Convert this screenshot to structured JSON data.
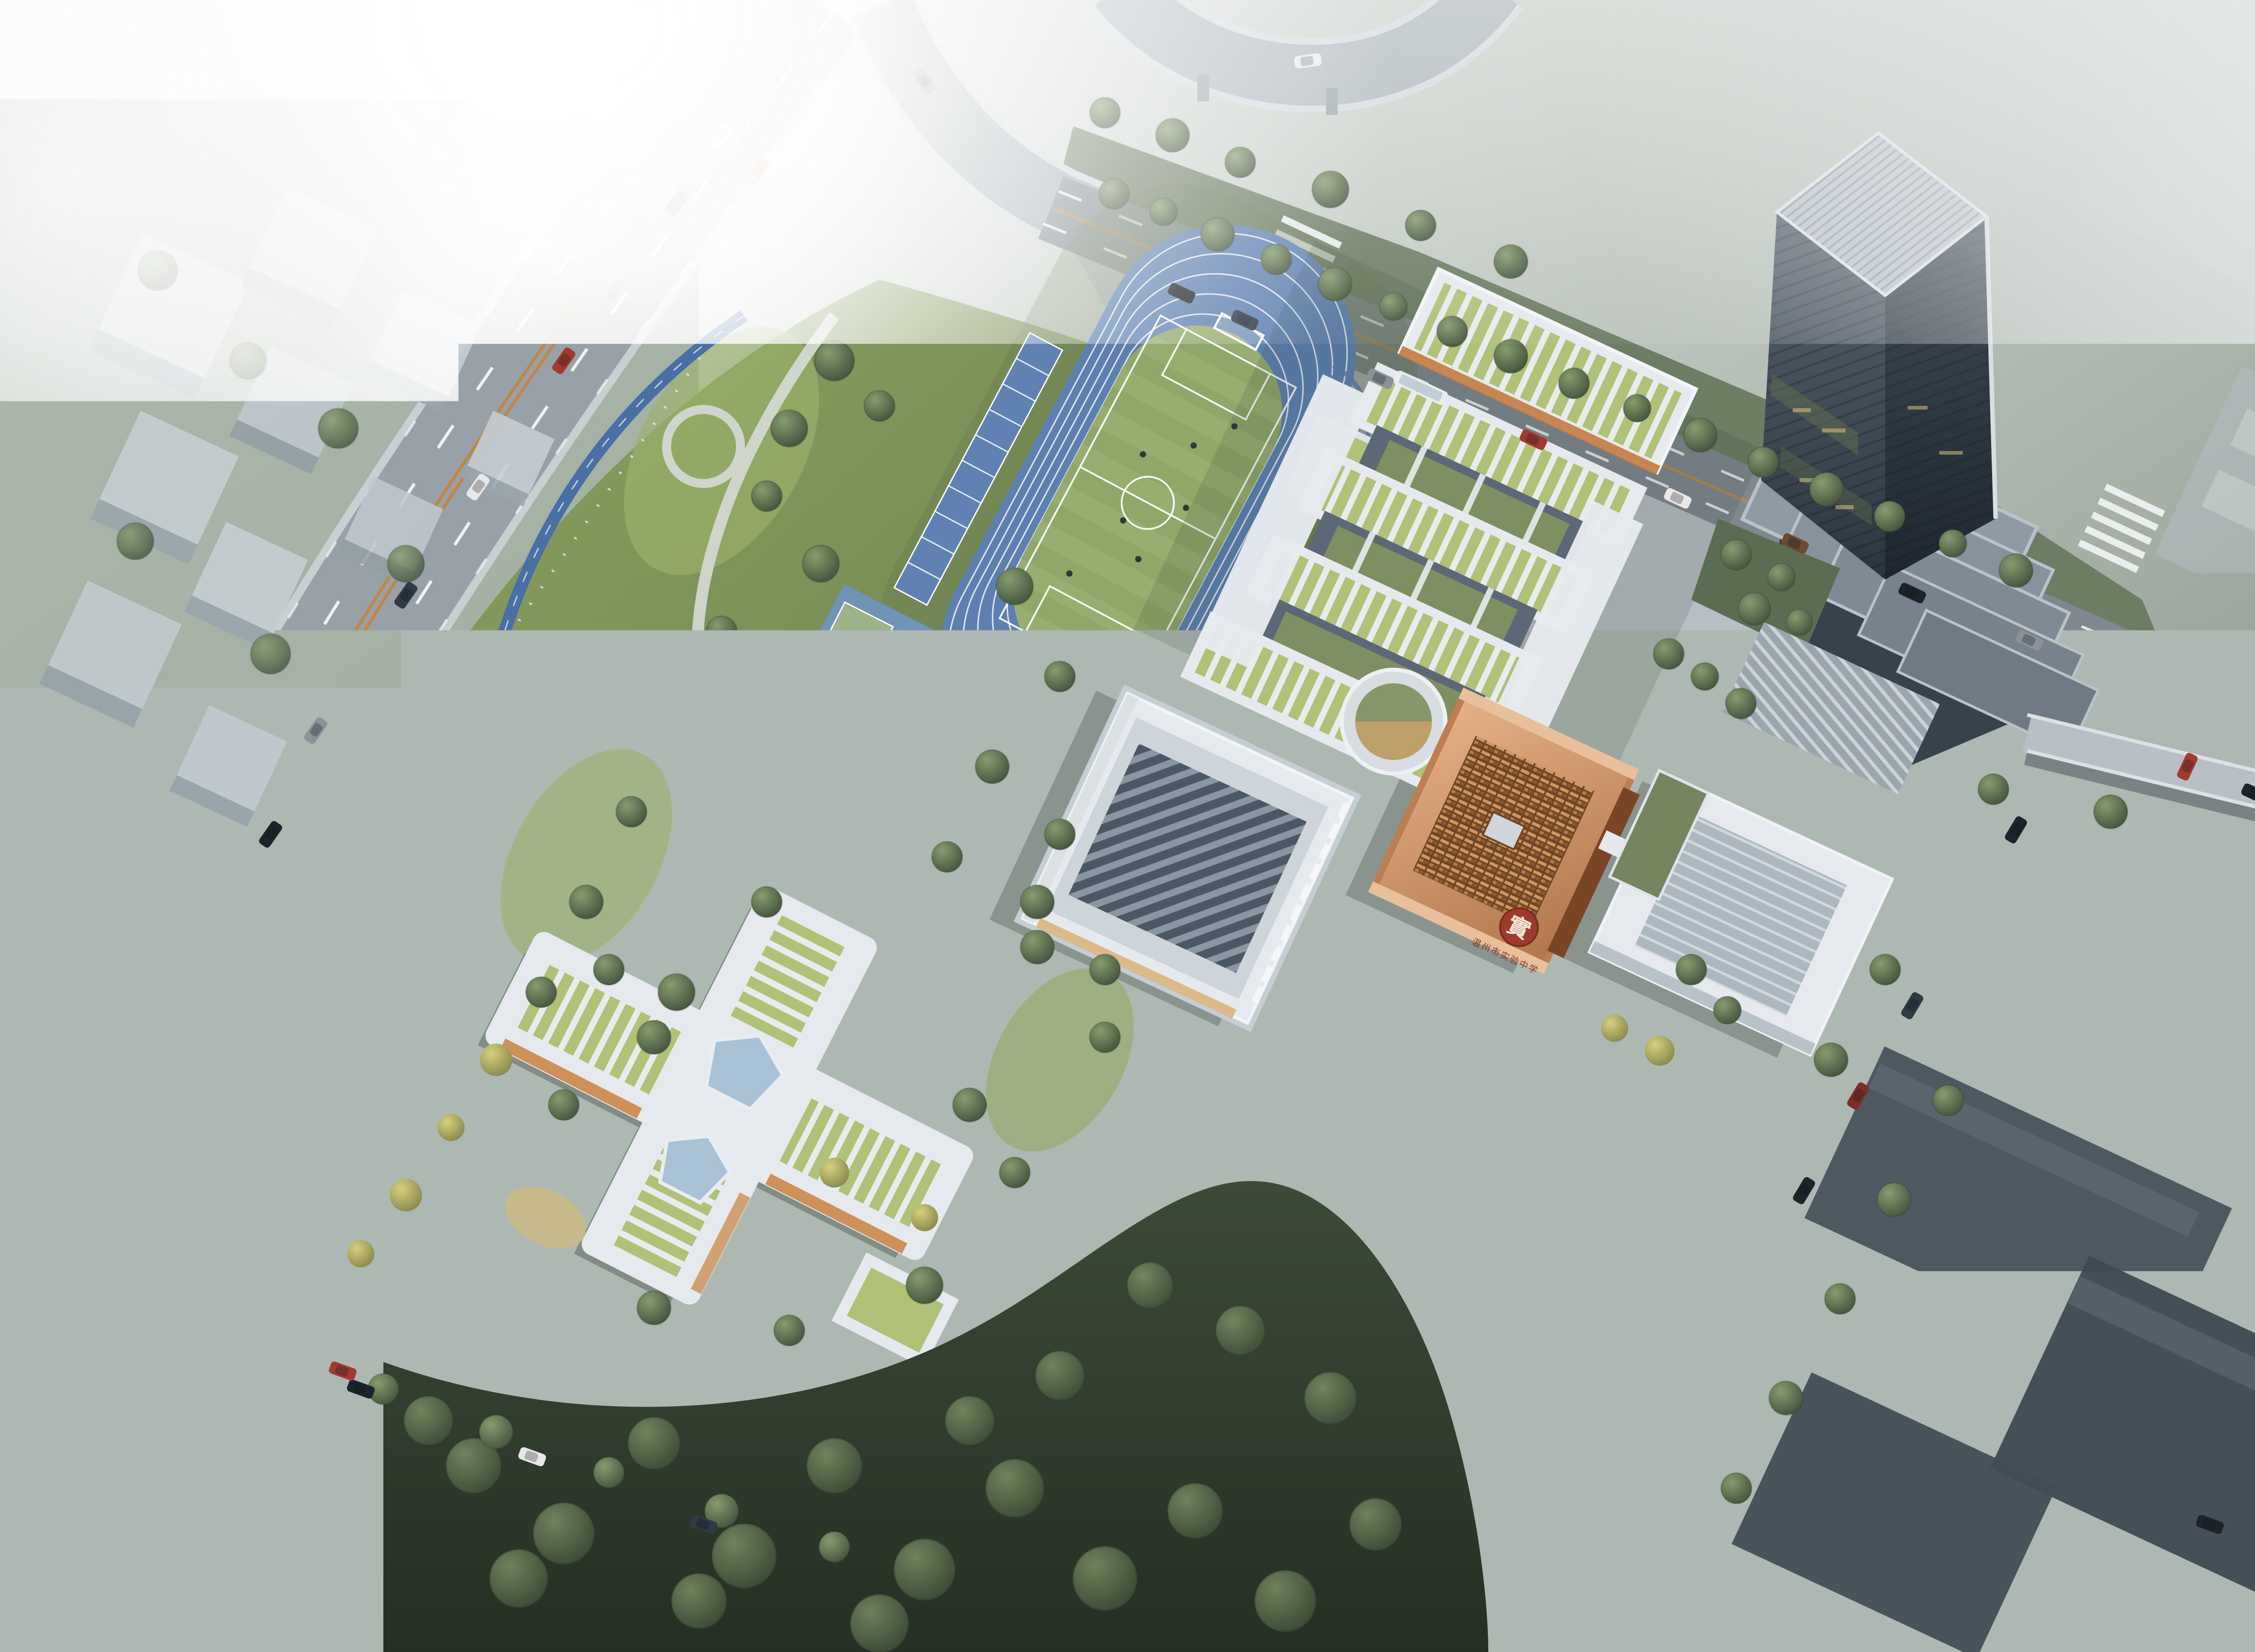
{
  "scene": {
    "kind": "aerial architectural rendering of a school campus at foggy dawn",
    "signage": {
      "seal_char": "實",
      "school_name": "温州市实验中学"
    }
  },
  "palette": {
    "track_blue": "#5d80b0",
    "jog_blue": "#4a6fa5",
    "field_green": "#8fa768",
    "park_green": "#7d9258",
    "forest_dark": "#33402f",
    "court_green": "#9db388",
    "court_blue": "#6f94b8",
    "tennis_red": "#9b5f5f",
    "roof_green": "#b0c178",
    "bldg_white": "#e6eaee",
    "copper": "#bc7e52",
    "copper_dark": "#6e4526",
    "tower_glass": "#3c4751",
    "asphalt_light": "#98a1a7",
    "asphalt_dark": "#47505a",
    "center_line_orange": "#c08648",
    "water_blue": "#5d81a3",
    "seal_red": "#9c3b2c"
  }
}
